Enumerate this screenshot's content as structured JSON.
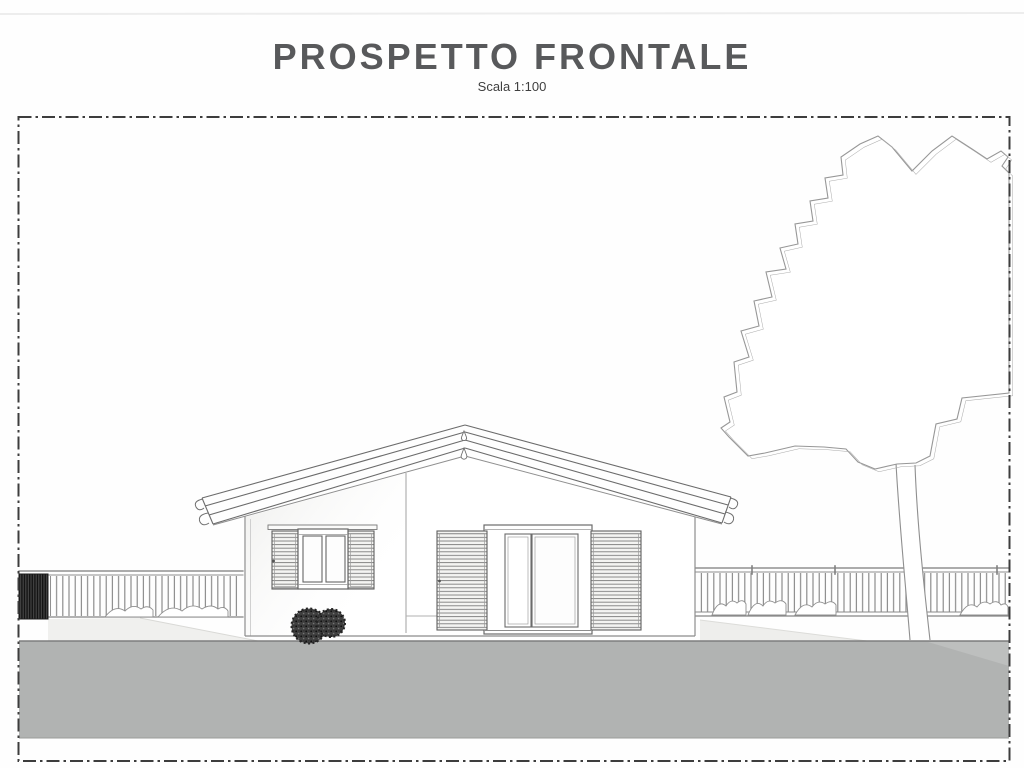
{
  "page": {
    "title": "PROSPETTO FRONTALE",
    "subtitle": "Scala 1:100"
  },
  "colors": {
    "title": "#58595b",
    "border": "#3d3d3d",
    "line": "#7a7a7a",
    "ground": "#b1b3b2",
    "bush": "#3f3f3f",
    "pillar": "#474747"
  },
  "drawing": {
    "type": "architectural-front-elevation",
    "elements": [
      "gable-roof-house",
      "window-with-louvered-shutters",
      "sliding-glass-door-with-louvered-shutters",
      "deciduous-tree",
      "left-railing-fence-with-masonry-pillar",
      "right-railing-fence",
      "round-bushes",
      "ground-strip",
      "dash-dot-drawing-frame"
    ]
  }
}
